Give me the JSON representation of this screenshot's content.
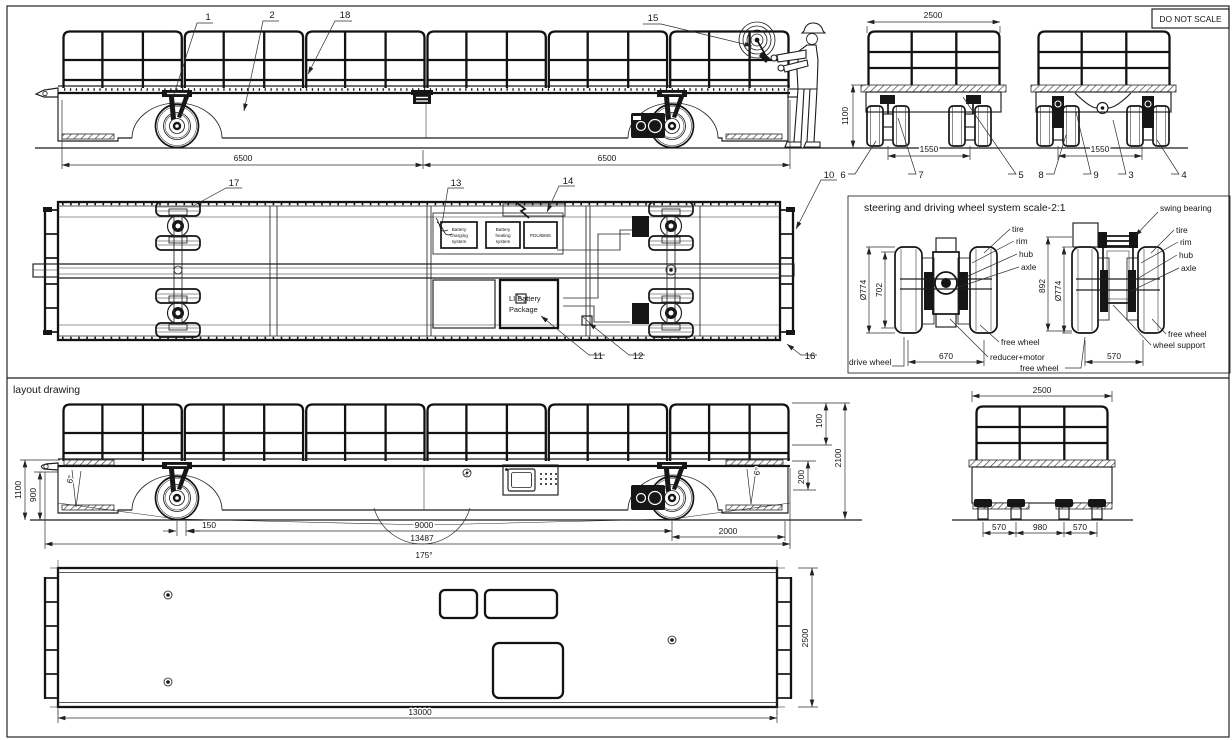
{
  "frame": {
    "do_not_scale": "DO NOT SCALE"
  },
  "sections": {
    "layout_drawing": "layout drawing",
    "steering_title": "steering and driving wheel system  scale-2:1"
  },
  "top_side": {
    "dim_left": "6500",
    "dim_right": "6500",
    "c1": "1",
    "c2": "2",
    "c18": "18",
    "c15": "15"
  },
  "top_end": {
    "dim_width": "2500",
    "dim_height": "1100",
    "dim_track_left": "1550",
    "dim_track_right": "1550",
    "c6": "6",
    "c7": "7",
    "c5": "5",
    "c8": "8",
    "c9": "9",
    "c3": "3",
    "c4": "4"
  },
  "plan": {
    "c17": "17",
    "c13": "13",
    "c14": "14",
    "c10": "10",
    "c11": "11",
    "c12": "12",
    "c16": "16",
    "charging": [
      "Battery",
      "charging",
      "system"
    ],
    "heating": [
      "Battery",
      "heating",
      "system"
    ],
    "pdu": "PDU/BMS",
    "battery": [
      "LI Battery",
      "Package"
    ]
  },
  "steer_left": {
    "dia": "Ø774",
    "h702": "702",
    "w670": "670",
    "tire": "tire",
    "rim": "rim",
    "hub": "hub",
    "axle": "axle",
    "free_top": "free wheel",
    "reducer": "reducer+motor",
    "free_bot": "free wheel",
    "drive": "drive wheel"
  },
  "steer_right": {
    "h892": "892",
    "dia": "Ø774",
    "w570": "570",
    "swing": "swing bearing",
    "tire": "tire",
    "rim": "rim",
    "hub": "hub",
    "axle": "axle",
    "free": "free wheel",
    "support": "wheel support"
  },
  "layout_side": {
    "d1100": "1100",
    "d900": "900",
    "a6_front": "6°",
    "d150": "150",
    "d9000": "9000",
    "d13487": "13487",
    "a175": "175°",
    "d2000": "2000",
    "a6_rear": "6°",
    "d100": "100",
    "d2100": "2100",
    "d200": "200"
  },
  "layout_end": {
    "width": "2500",
    "t570l": "570",
    "t980": "980",
    "t570r": "570"
  },
  "bottom_plan": {
    "length": "13000",
    "width": "2500"
  }
}
